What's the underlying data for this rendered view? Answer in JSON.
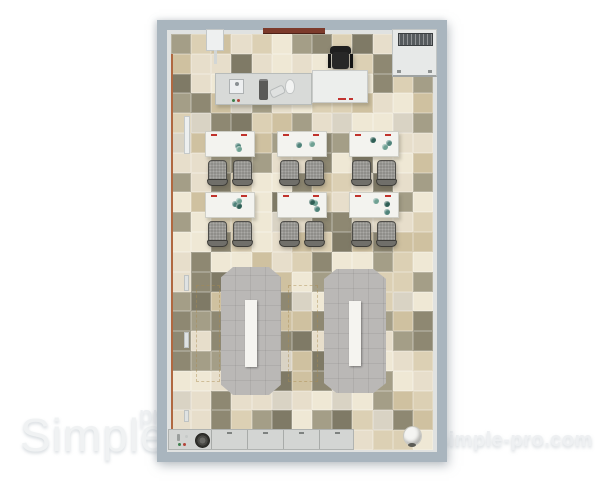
{
  "watermark": {
    "brand": "Simple",
    "brand_suffix": "pro",
    "site_url": "simple-pro.com",
    "text_color": "#f0f2f3"
  },
  "room": {
    "wall_color": "#a9b5be",
    "inner_trim_color": "#e0e2e1",
    "accent_trim_color": "#b06840",
    "board_color": "#7c3a2b",
    "floor": {
      "cols": 13,
      "rows": 21,
      "tile_palette": [
        "#efe8d5",
        "#e7decb",
        "#dcd0b4",
        "#cfc1a0",
        "#d9d3c4",
        "#a49e87",
        "#8e8872",
        "#7f7a66"
      ],
      "tile_weights": [
        0.2,
        0.17,
        0.13,
        0.1,
        0.12,
        0.1,
        0.1,
        0.08
      ]
    }
  },
  "furniture": {
    "student_desk_count": 6,
    "student_desk_rows": 2,
    "student_desk_cols": 3,
    "chairs_per_desk": 2,
    "booth_count": 2,
    "desk_color": "#f3f3ef",
    "chair_color": "#8f8e8a",
    "booth_color": "#bab8b6",
    "booth_table_color": "#f5f4f0",
    "desk_accessory_colors": [
      "#4f837a",
      "#6fa193",
      "#2f5f55"
    ],
    "desk_corner_mark_color": "#c0332c",
    "office_chair_color": "#1f1f1f"
  }
}
